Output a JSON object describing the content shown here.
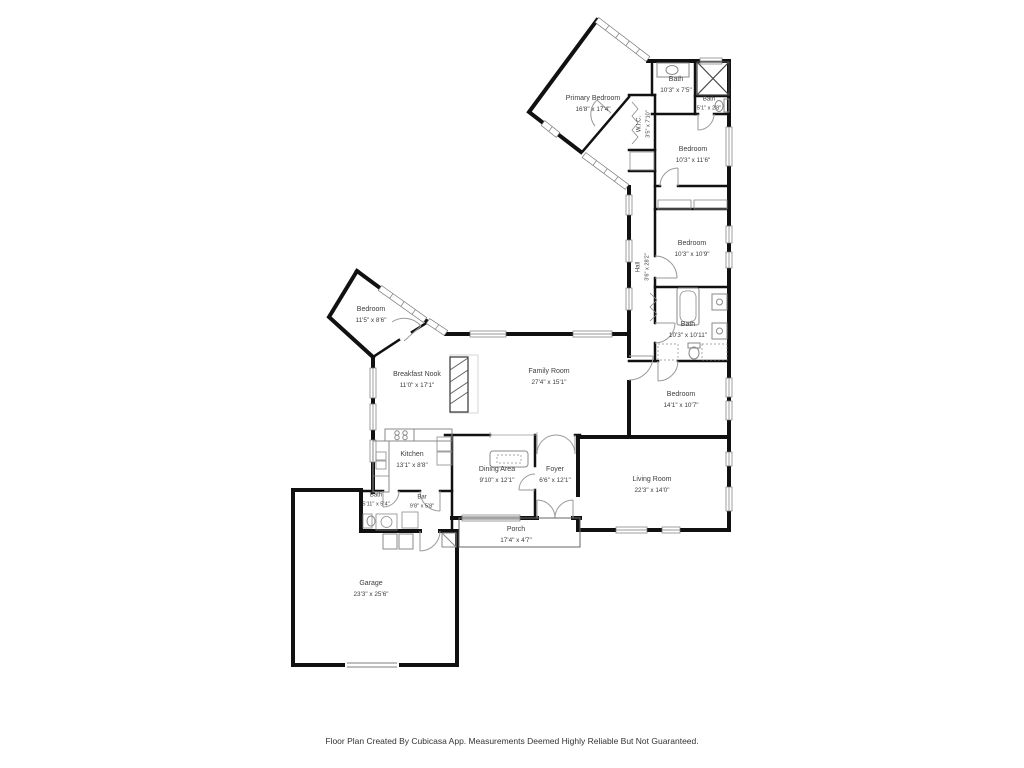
{
  "floor_plan": {
    "colors": {
      "wall": "#111111",
      "fixture": "#8a8a8a",
      "label_text": "#3d3d3d",
      "background": "#ffffff"
    },
    "rooms": [
      {
        "id": "primary-bedroom",
        "name": "Primary Bedroom",
        "dims": "16'8\" x 17'4\""
      },
      {
        "id": "bath-top",
        "name": "Bath",
        "dims": "10'3\" x 7'5\""
      },
      {
        "id": "bath-small",
        "name": "Bath",
        "dims": "5'1\" x 2'8\""
      },
      {
        "id": "wic",
        "name": "W.I.C.",
        "dims": "3'5\" x 7'10\""
      },
      {
        "id": "bedroom-ne",
        "name": "Bedroom",
        "dims": "10'3\" x 11'6\""
      },
      {
        "id": "bedroom-e",
        "name": "Bedroom",
        "dims": "10'3\" x 10'9\""
      },
      {
        "id": "hall",
        "name": "Hall",
        "dims": "3'6\" x 28'2\""
      },
      {
        "id": "bath-e",
        "name": "Bath",
        "dims": "10'3\" x 10'11\""
      },
      {
        "id": "bedroom-se",
        "name": "Bedroom",
        "dims": "14'1\" x 10'7\""
      },
      {
        "id": "bedroom-w",
        "name": "Bedroom",
        "dims": "11'5\" x 8'6\""
      },
      {
        "id": "breakfast-nook",
        "name": "Breakfast Nook",
        "dims": "11'0\" x 17'1\""
      },
      {
        "id": "family-room",
        "name": "Family Room",
        "dims": "27'4\" x 15'1\""
      },
      {
        "id": "kitchen",
        "name": "Kitchen",
        "dims": "13'1\" x 8'8\""
      },
      {
        "id": "dining-area",
        "name": "Dining Area",
        "dims": "9'10\" x 12'1\""
      },
      {
        "id": "foyer",
        "name": "Foyer",
        "dims": "6'6\" x 12'1\""
      },
      {
        "id": "bath-w",
        "name": "Bath",
        "dims": "5'11\" x 5'4\""
      },
      {
        "id": "bar",
        "name": "Bar",
        "dims": "9'8\" x 5'8\""
      },
      {
        "id": "living-room",
        "name": "Living Room",
        "dims": "22'3\" x 14'0\""
      },
      {
        "id": "porch",
        "name": "Porch",
        "dims": "17'4\" x 4'7\""
      },
      {
        "id": "garage",
        "name": "Garage",
        "dims": "23'3\" x 25'6\""
      }
    ],
    "footer": "Floor Plan Created By Cubicasa App. Measurements Deemed Highly Reliable But Not Guaranteed."
  }
}
